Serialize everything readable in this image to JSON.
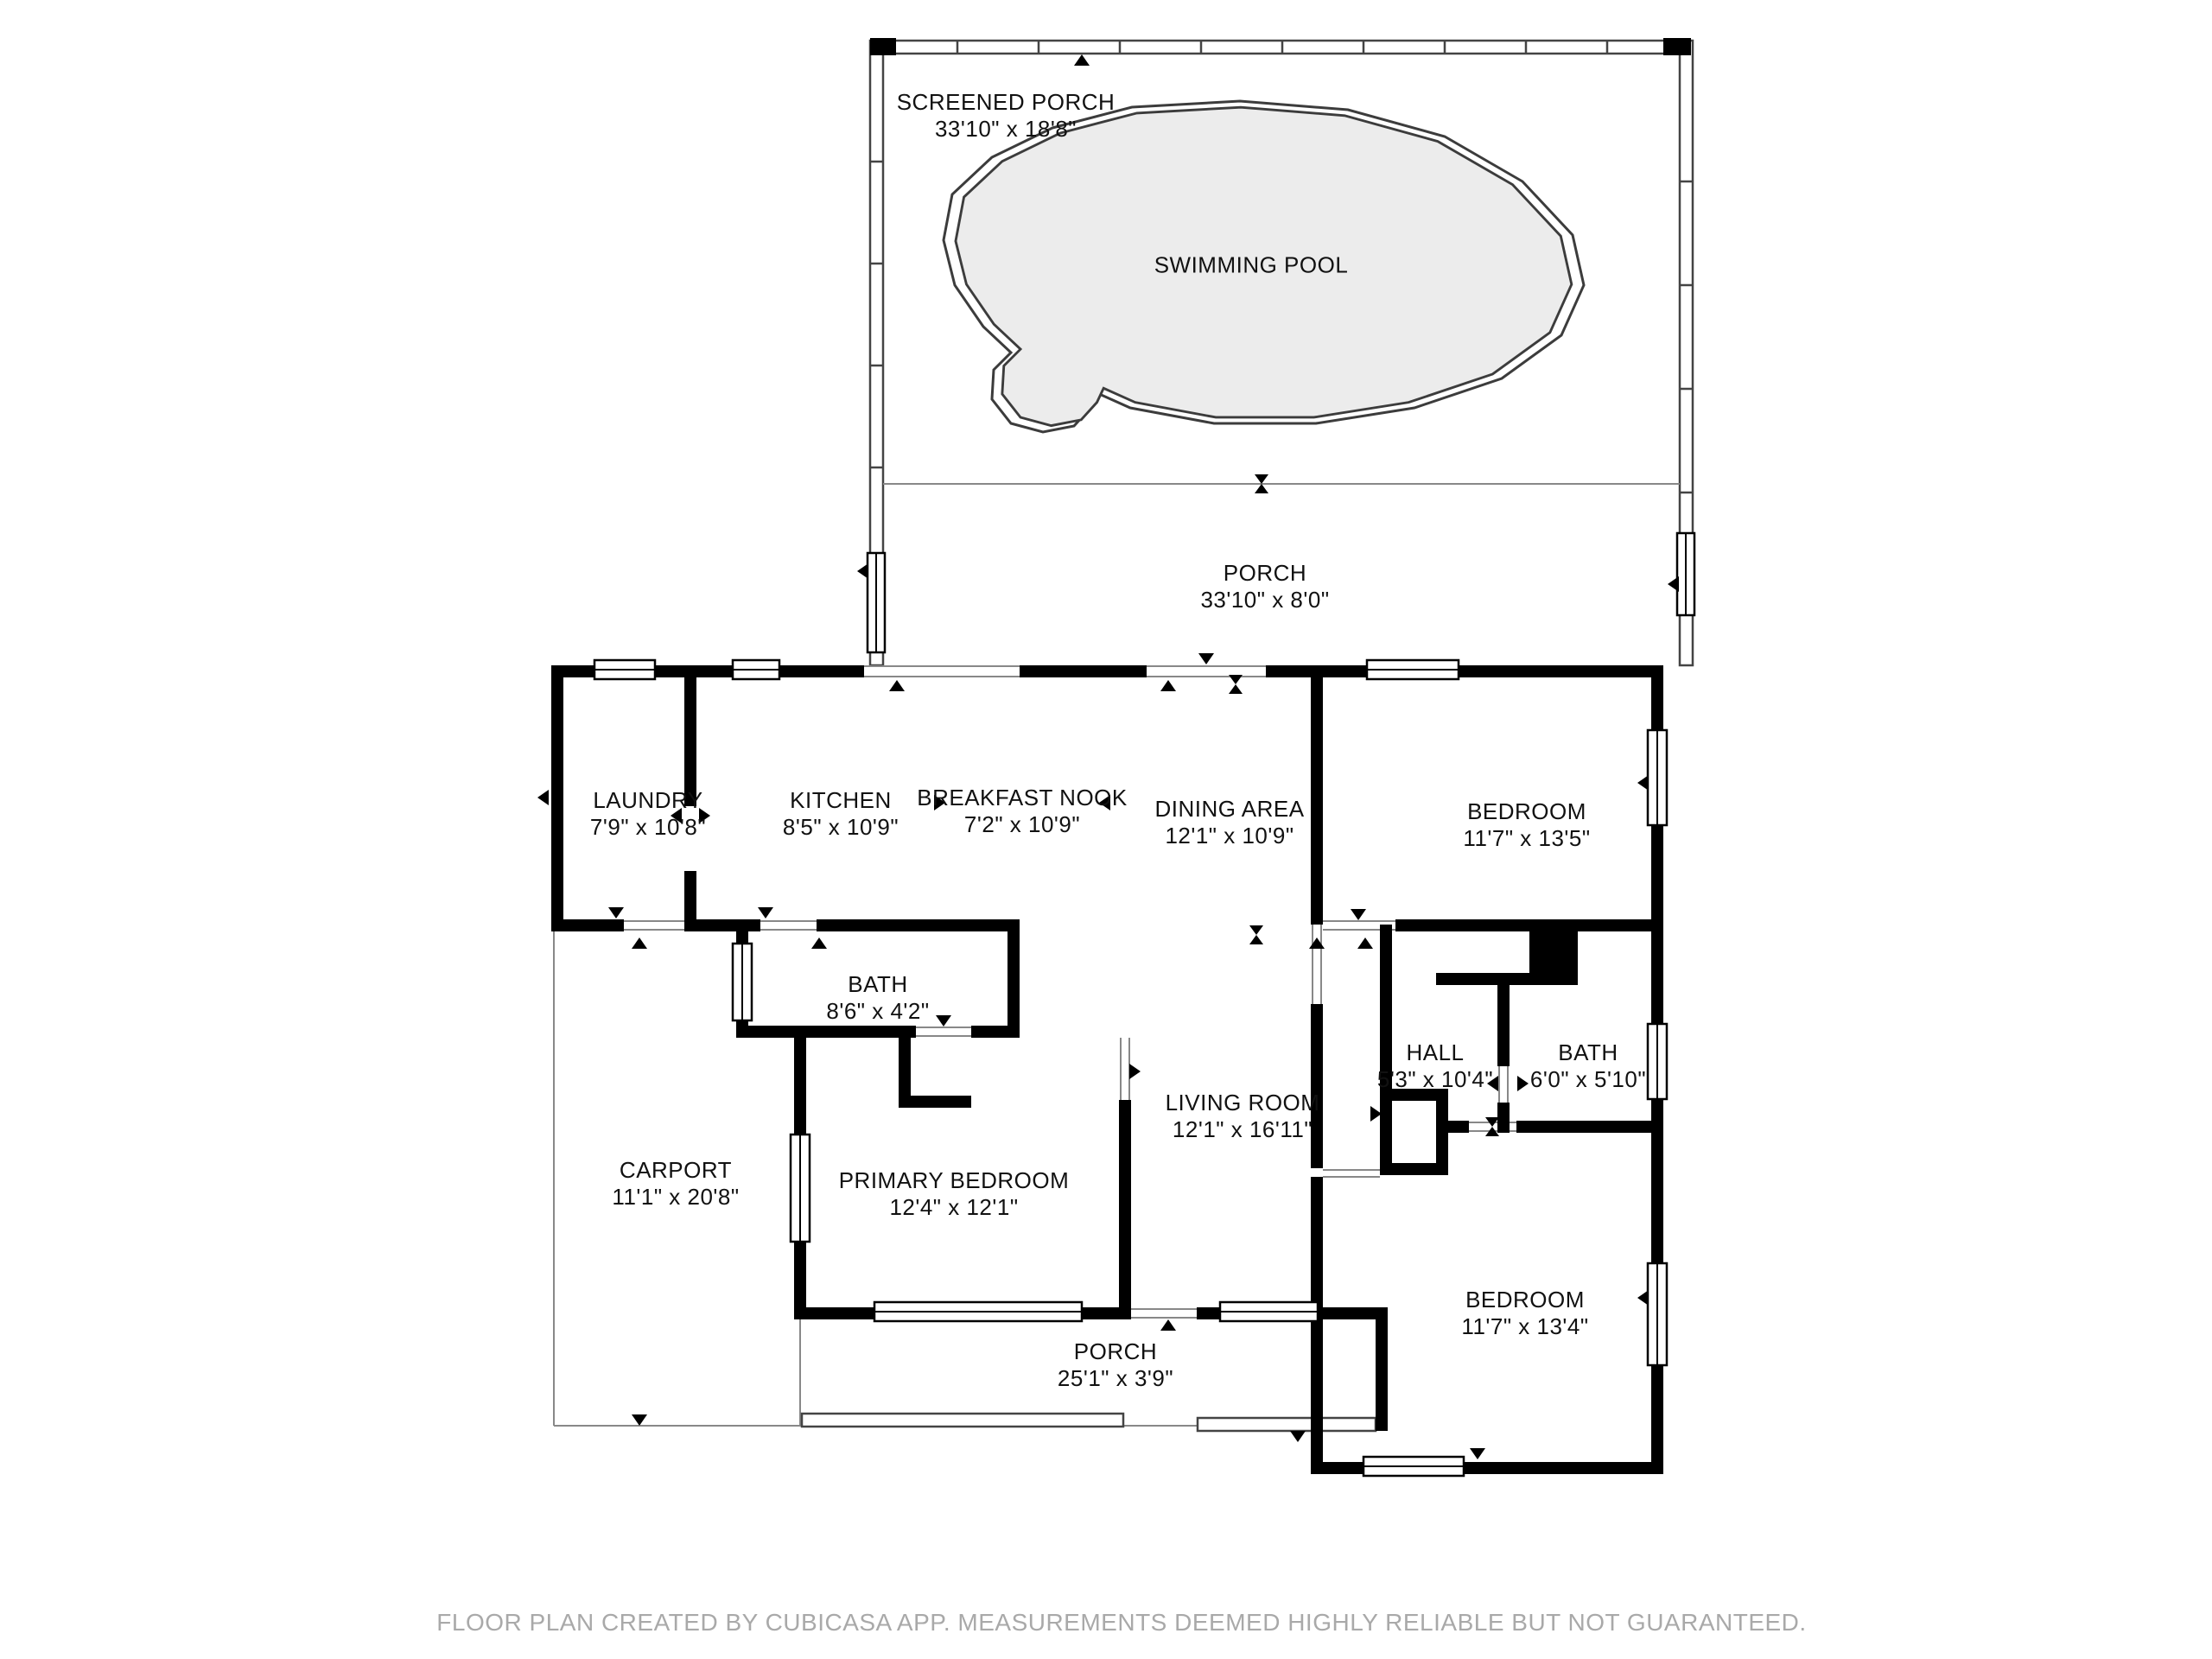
{
  "title": "Floor plan",
  "colors": {
    "wall": "#000000",
    "pool_fill": "#ececec",
    "pool_outline": "#3c3c3c",
    "thin_line": "#888888",
    "label_text": "#111111",
    "footer_text": "#a9a9a9",
    "background": "#ffffff"
  },
  "rooms": {
    "screened_porch": {
      "name": "SCREENED PORCH",
      "dims": "33'10\" x 18'8\""
    },
    "swimming_pool": {
      "name": "SWIMMING POOL"
    },
    "porch_top": {
      "name": "PORCH",
      "dims": "33'10\" x 8'0\""
    },
    "laundry": {
      "name": "LAUNDRY",
      "dims": "7'9\" x 10'8\""
    },
    "kitchen": {
      "name": "KITCHEN",
      "dims": "8'5\" x 10'9\""
    },
    "breakfast_nook": {
      "name": "BREAKFAST NOOK",
      "dims": "7'2\" x 10'9\""
    },
    "dining_area": {
      "name": "DINING AREA",
      "dims": "12'1\" x 10'9\""
    },
    "bedroom_ne": {
      "name": "BEDROOM",
      "dims": "11'7\" x 13'5\""
    },
    "bath_left": {
      "name": "BATH",
      "dims": "8'6\" x 4'2\""
    },
    "hall": {
      "name": "HALL",
      "dims": "5'3\" x 10'4\""
    },
    "bath_right": {
      "name": "BATH",
      "dims": "6'0\" x 5'10\""
    },
    "living_room": {
      "name": "LIVING ROOM",
      "dims": "12'1\" x 16'11\""
    },
    "carport": {
      "name": "CARPORT",
      "dims": "11'1\" x 20'8\""
    },
    "primary_bedroom": {
      "name": "PRIMARY BEDROOM",
      "dims": "12'4\" x 12'1\""
    },
    "porch_bottom": {
      "name": "PORCH",
      "dims": "25'1\" x 3'9\""
    },
    "bedroom_se": {
      "name": "BEDROOM",
      "dims": "11'7\" x 13'4\""
    }
  },
  "footer": {
    "text": "FLOOR PLAN CREATED BY CUBICASA APP. MEASUREMENTS DEEMED HIGHLY RELIABLE BUT NOT GUARANTEED."
  }
}
